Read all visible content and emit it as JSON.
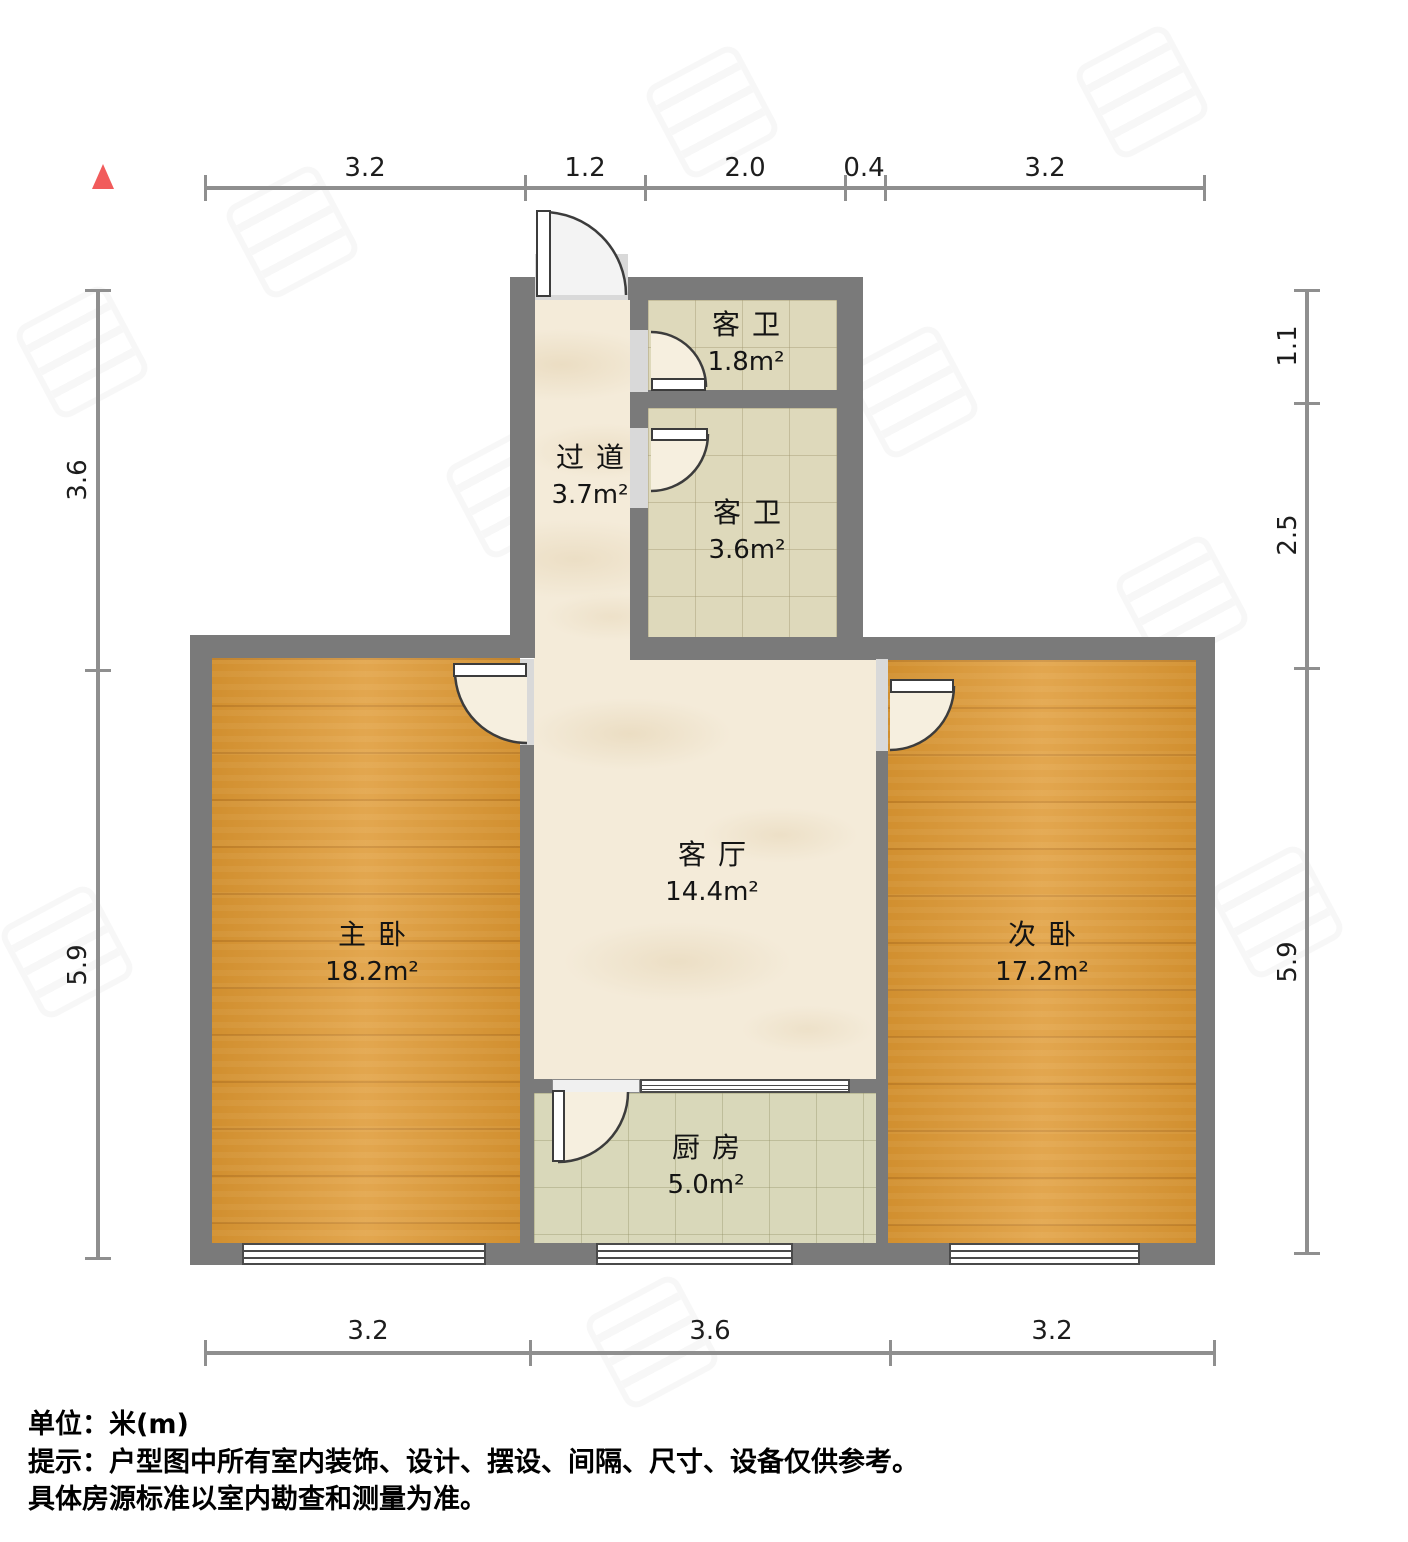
{
  "rooms": {
    "bath1": {
      "name": "客卫",
      "area": "1.8m²"
    },
    "hallway": {
      "name": "过道",
      "area": "3.7m²"
    },
    "bath2": {
      "name": "客卫",
      "area": "3.6m²"
    },
    "living": {
      "name": "客厅",
      "area": "14.4m²"
    },
    "master": {
      "name": "主卧",
      "area": "18.2m²"
    },
    "second": {
      "name": "次卧",
      "area": "17.2m²"
    },
    "kitchen": {
      "name": "厨房",
      "area": "5.0m²"
    }
  },
  "dimensions": {
    "top": [
      "3.2",
      "1.2",
      "2.0",
      "0.4",
      "3.2"
    ],
    "left": [
      "3.6",
      "5.9"
    ],
    "right": [
      "1.1",
      "2.5",
      "5.9"
    ],
    "bottom": [
      "3.2",
      "3.6",
      "3.2"
    ]
  },
  "notes": {
    "unit": "单位：米(m)",
    "tip": "提示：户型图中所有室内装饰、设计、摆设、间隔、尺寸、设备仅供参考。",
    "tip2": "具体房源标准以室内勘查和测量为准。"
  },
  "icons": {
    "north_indicator": "north-triangle"
  },
  "colors": {
    "wall": "#7a7a7a",
    "wood_floor": "#de9832",
    "marble_floor": "#f4ebd9",
    "bath_tile": "#ded9bb",
    "kitchen_tile": "#d9d8ba",
    "north_marker": "#f15b5b",
    "dimension_line": "#8f8f8f"
  }
}
